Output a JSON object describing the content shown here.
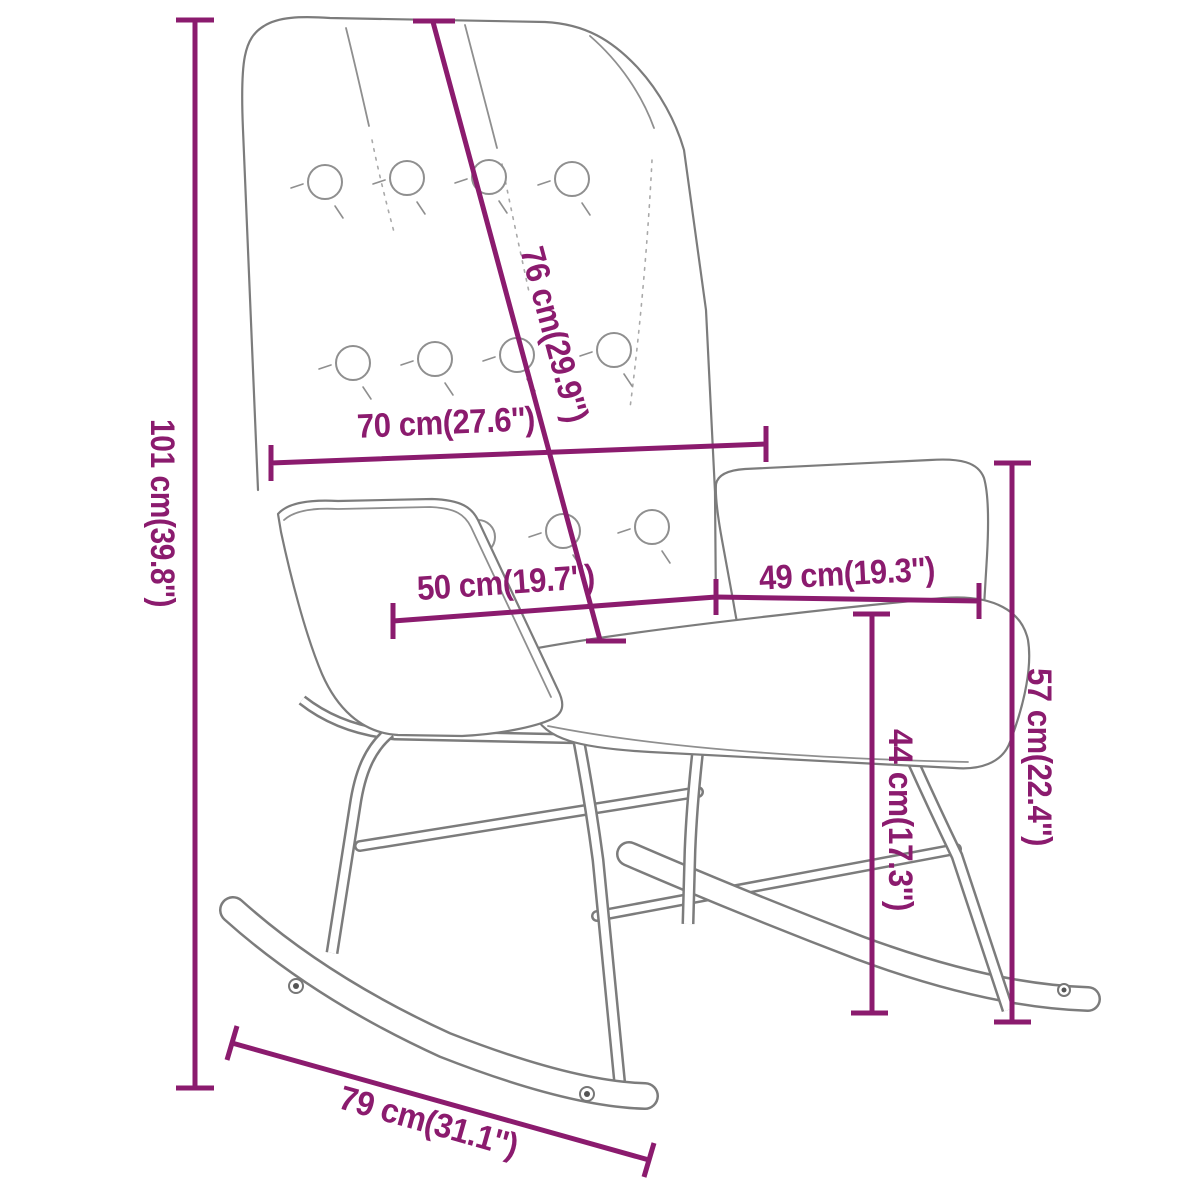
{
  "figure": {
    "type": "product-dimension-diagram",
    "subject": "tufted rocking chair line drawing",
    "background_color": "#ffffff",
    "outline_color": "#7c7c7c",
    "accent_color": "#8b1b6e"
  },
  "dimensions": [
    {
      "id": "overall-height",
      "label": "101 cm(39.8'')"
    },
    {
      "id": "backrest-length",
      "label": "76 cm(29.9'')"
    },
    {
      "id": "backrest-width",
      "label": "70 cm(27.6'')"
    },
    {
      "id": "seat-depth",
      "label": "50 cm(19.7'')"
    },
    {
      "id": "armrest-length",
      "label": "49 cm(19.3'')"
    },
    {
      "id": "armrest-height",
      "label": "57 cm(22.4'')"
    },
    {
      "id": "seat-height",
      "label": "44 cm(17.3'')"
    },
    {
      "id": "rocker-length",
      "label": "79 cm(31.1'')"
    }
  ]
}
